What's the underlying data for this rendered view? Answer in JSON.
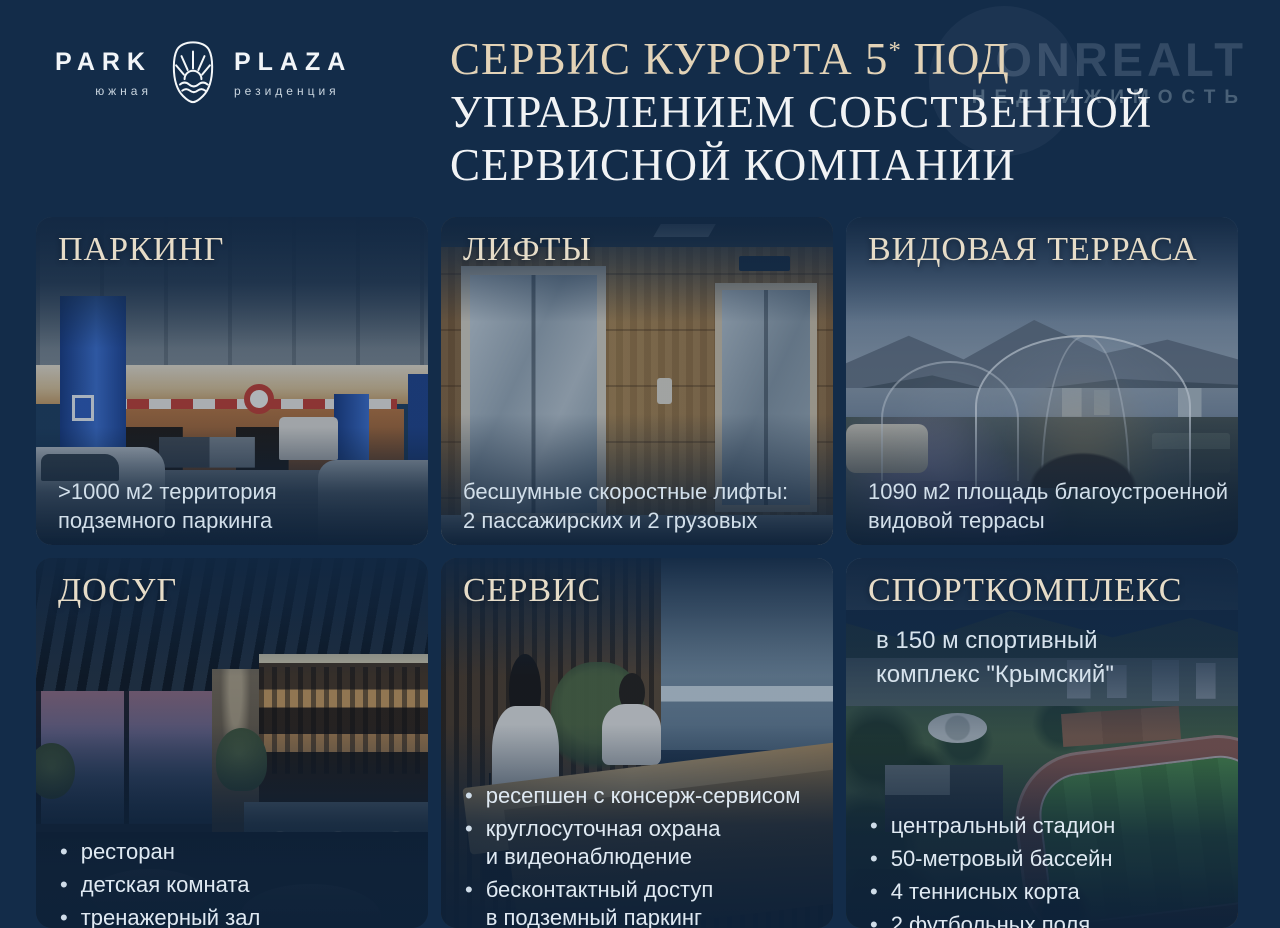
{
  "theme": {
    "background": "#132c49",
    "card_background": "#1c3a59",
    "title_cream": "#e3d3b7",
    "title_white": "#f1f3f5",
    "card_header_cream": "#e6dcc8",
    "caption_color": "#d2dfea",
    "bullet_color": "#dfe9f2"
  },
  "logo": {
    "park": "PARK",
    "park_sub": "южная",
    "plaza": "PLAZA",
    "plaza_sub": "резиденция",
    "emblem": "sun-over-sea-crest"
  },
  "watermark": {
    "name": "ONREALT",
    "subtitle": "НЕДВИЖИМОСТЬ"
  },
  "title": {
    "line1_pre": "СЕРВИС КУРОРТА 5",
    "line1_star": "*",
    "line1_post": "ПОД",
    "line2": "УПРАВЛЕНИЕМ СОБСТВЕННОЙ",
    "line3": "СЕРВИСНОЙ КОМПАНИИ"
  },
  "cards": [
    {
      "id": "parking",
      "title": "ПАРКИНГ",
      "photo": "underground-parking",
      "caption_lines": [
        ">1000 м2 территория",
        "подземного паркинга"
      ]
    },
    {
      "id": "lifts",
      "title": "ЛИФТЫ",
      "photo": "elevator-hall",
      "caption_lines": [
        "бесшумные скоростные лифты:",
        "2 пассажирских и 2 грузовых"
      ]
    },
    {
      "id": "terrace",
      "title": "ВИДОВАЯ ТЕРРАСА",
      "photo": "rooftop-terrace-domes",
      "caption_lines": [
        "1090 м2 площадь благоустроенной",
        "видовой террасы"
      ]
    },
    {
      "id": "leisure",
      "title": "ДОСУГ",
      "photo": "restaurant-bar",
      "bullets": [
        {
          "lines": [
            "ресторан"
          ]
        },
        {
          "lines": [
            "детская комната"
          ]
        },
        {
          "lines": [
            "тренажерный зал"
          ]
        }
      ]
    },
    {
      "id": "service",
      "title": "СЕРВИС",
      "photo": "reception-desk",
      "bullets": [
        {
          "lines": [
            "ресепшен с консерж-сервисом"
          ]
        },
        {
          "lines": [
            "круглосуточная охрана",
            "и видеонаблюдение"
          ]
        },
        {
          "lines": [
            "бесконтактный доступ",
            "в подземный паркинг"
          ]
        }
      ]
    },
    {
      "id": "sport",
      "title": "СПОРТКОМПЛЕКС",
      "photo": "stadium-aerial",
      "subtitle_lines": [
        "в 150 м спортивный",
        "комплекс \"Крымский\""
      ],
      "bullets": [
        {
          "lines": [
            "центральный стадион"
          ]
        },
        {
          "lines": [
            "50-метровый бассейн"
          ]
        },
        {
          "lines": [
            "4 теннисных корта"
          ]
        },
        {
          "lines": [
            "2 футбольных поля"
          ]
        }
      ]
    }
  ]
}
